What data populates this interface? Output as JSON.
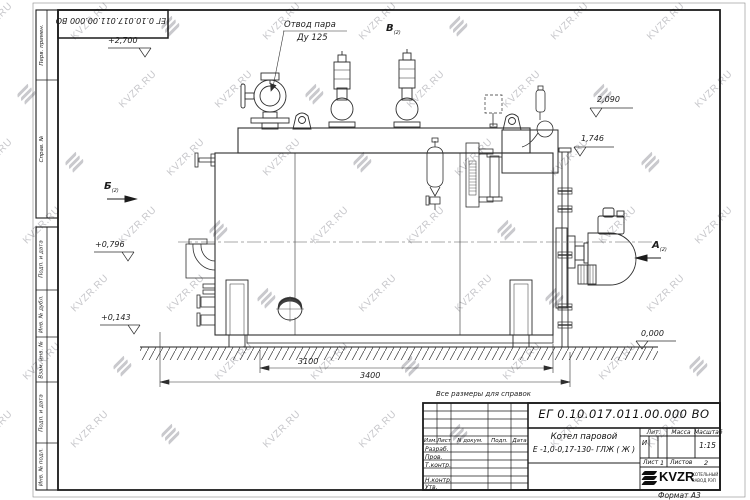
{
  "watermark": {
    "text": "KVZR.RU"
  },
  "page": {
    "stamp_top": "ЕГ 0.10.017.011.00.000  ВО",
    "note": "Все размеры для справок",
    "format": "Формат А3"
  },
  "frame_labels": {
    "perv_primen": "Перв. примен.",
    "sprav_no": "Справ. №",
    "podp_data_1": "Подп. и дата",
    "inv_dubl": "Инв. № дубл.",
    "vzam_inv": "Взам. инв. №",
    "podp_data_2": "Подп. и дата",
    "inv_podl": "Инв. № подл."
  },
  "annotations": {
    "steam_outlet_line1": "Отвод пара",
    "steam_outlet_line2": "Ду 125",
    "view_a": "А",
    "view_b": "Б",
    "view_v": "В",
    "view_sub": "(2)",
    "elev_2700": "+2,700",
    "elev_2090": "2,090",
    "elev_1746": "1,746",
    "elev_0796": "+0,796",
    "elev_0143": "+0,143",
    "elev_0000": "0,000",
    "dim_3100": "3100",
    "dim_3400": "3400"
  },
  "title_block": {
    "designation": "ЕГ 0.10.017.011.00.000  ВО",
    "product_name_line1": "Котел паровой",
    "product_name_line2": "Е -1,0-0,17-130- ГЛЖ ( Ж )",
    "header_izm": "Изм.",
    "header_list": "Лист",
    "header_doc": "N докум.",
    "header_podp": "Подп.",
    "header_data": "Дата",
    "row_razrab": "Разраб.",
    "row_prov": "Пров.",
    "row_tkontr": "Т.контр.",
    "row_nkontr": "Н.контр.",
    "row_utv": "Утв.",
    "lit_label": "Лит.",
    "massa_label": "Масса",
    "masshtab_label": "Масштаб",
    "lit_value": "И",
    "masshtab_value": "1:15",
    "list_label": "Лист",
    "list_value": "1",
    "listov_label": "Листов",
    "listov_value": "2",
    "logo_text": "KVZR",
    "logo_sub1": "КОТЕЛЬНЫЙ",
    "logo_sub2": "ЗАВОД РЭП"
  }
}
